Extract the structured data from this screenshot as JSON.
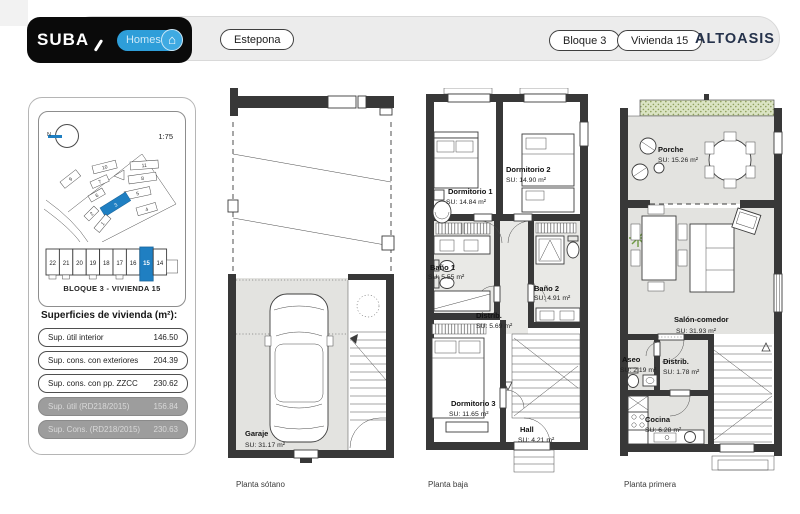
{
  "topbar": {
    "logo": "SUBA",
    "homes_label": "Homes",
    "home_icon": "⌂",
    "location_label": "Estepona",
    "bloque_label": "Bloque 3",
    "vivienda_label": "Vivienda 15",
    "brand": "ALTOASIS"
  },
  "sidebar": {
    "compass_label": "N",
    "scale": "1:75",
    "site_blocks": [
      "1",
      "2",
      "3",
      "4",
      "5",
      "6",
      "7",
      "8",
      "9",
      "10",
      "11"
    ],
    "units": [
      "22",
      "21",
      "20",
      "19",
      "18",
      "17",
      "16",
      "15",
      "14"
    ],
    "selected_unit": "15",
    "block_title": "BLOQUE 3 - VIVIENDA 15",
    "surfaces_title": "Superficies de vivienda (m²):",
    "surfaces": [
      {
        "label": "Sup. útil interior",
        "value": "146.50"
      },
      {
        "label": "Sup. cons. con exteriores",
        "value": "204.39"
      },
      {
        "label": "Sup. cons. con pp. ZZCC",
        "value": "230.62"
      },
      {
        "label": "Sup. útil (RD218/2015)",
        "value": "156.84"
      },
      {
        "label": "Sup. Cons. (RD218/2015)",
        "value": "230.63"
      }
    ]
  },
  "plans": [
    {
      "caption": "Planta sótano",
      "rooms": [
        {
          "name": "Garaje",
          "su": "SU: 31.17 m²"
        }
      ]
    },
    {
      "caption": "Planta baja",
      "rooms": [
        {
          "name": "Dormitorio 1",
          "su": "SU: 14.84 m²"
        },
        {
          "name": "Dormitorio 2",
          "su": "SU: 14.90 m²"
        },
        {
          "name": "Baño 1",
          "su": "SU: 5.55 m²"
        },
        {
          "name": "Baño 2",
          "su": "SU: 4.91 m²"
        },
        {
          "name": "Distrib.",
          "su": "SU: 5.69 m²"
        },
        {
          "name": "Dormitorio 3",
          "su": "SU: 11.65 m²"
        },
        {
          "name": "Hall",
          "su": "SU: 4.21 m²"
        }
      ]
    },
    {
      "caption": "Planta primera",
      "rooms": [
        {
          "name": "Porche",
          "su": "SU: 15.26 m²"
        },
        {
          "name": "Salón-comedor",
          "su": "SU: 31.93 m²"
        },
        {
          "name": "Aseo",
          "su": "SU: 2.19 m²"
        },
        {
          "name": "Distrib.",
          "su": "SU: 1.78 m²"
        },
        {
          "name": "Cocina",
          "su": "SU: 6.28 m²"
        }
      ]
    }
  ],
  "colors": {
    "accent_blue": "#1f7fc2",
    "homes_blue": "#2e9ed9",
    "topbar_black": "#0a0a0a",
    "bar_gray": "#ececec",
    "floor_gray": "#e3e3e0",
    "wall_dark": "#383838",
    "brand_navy": "#25324b"
  }
}
